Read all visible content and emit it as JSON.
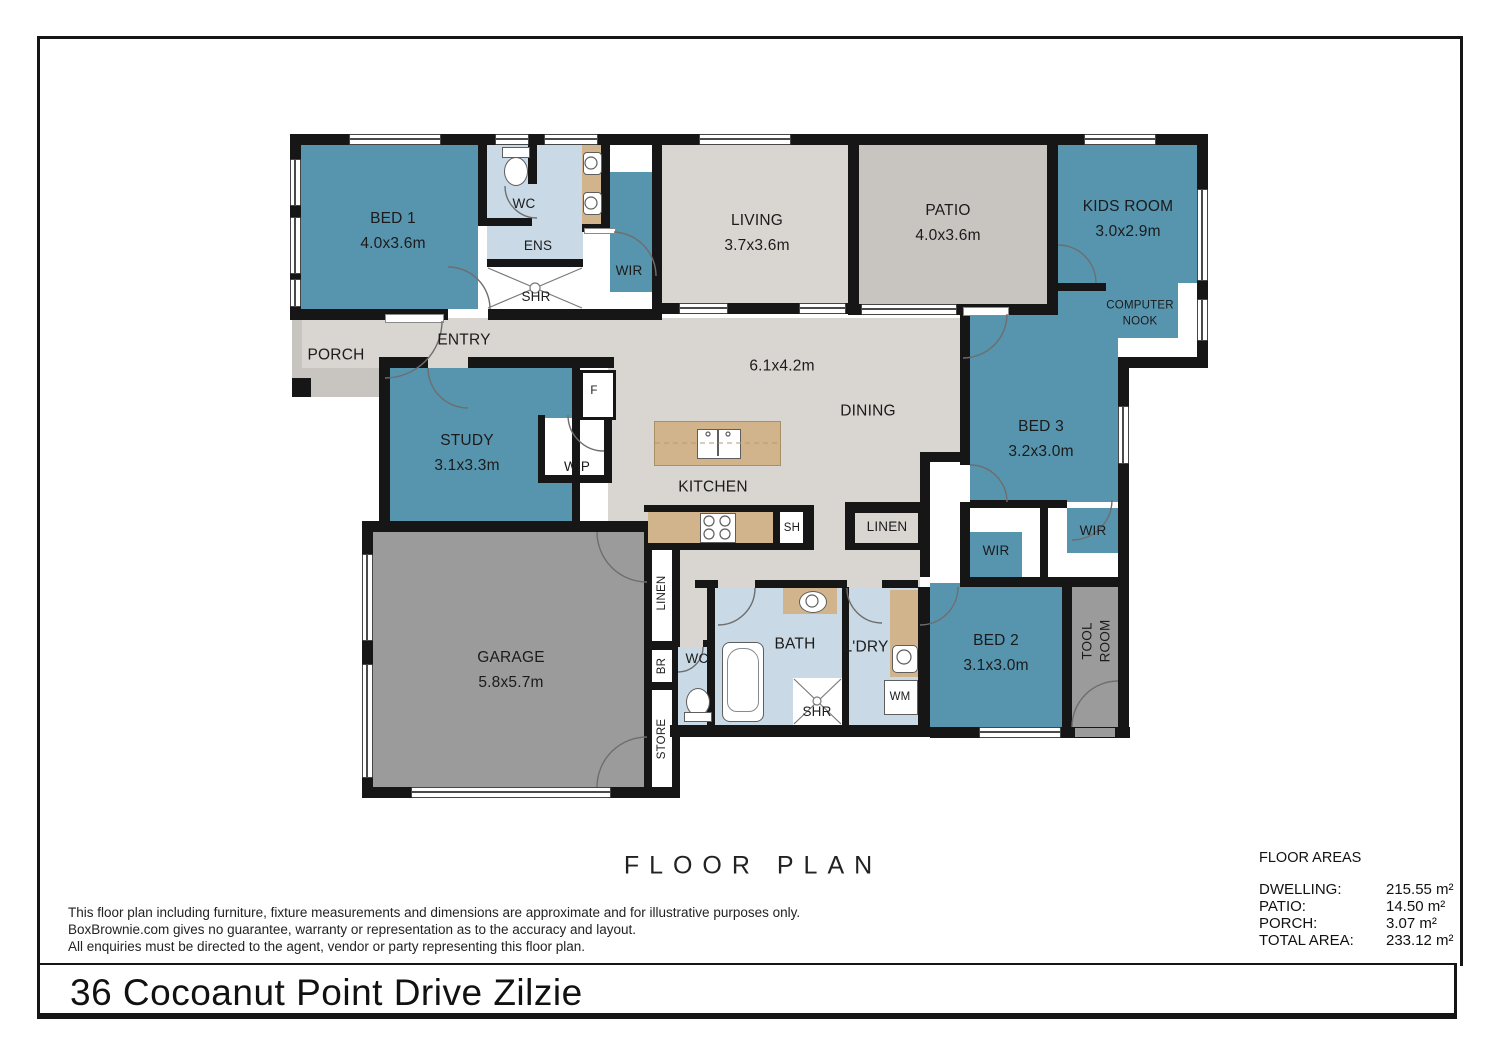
{
  "footer": {
    "title": "F L O O R   P L A N",
    "title_plain": "FLOOR PLAN",
    "address": "36 Cocoanut Point Drive Zilzie",
    "disclaimer": [
      "This floor plan including furniture, fixture measurements and dimensions are approximate and for illustrative purposes only.",
      "BoxBrownie.com gives no guarantee, warranty or representation as to the accuracy and layout.",
      "All enquiries must be directed to the agent, vendor or party representing this floor plan."
    ]
  },
  "floor_areas": {
    "heading": "FLOOR AREAS",
    "rows": [
      {
        "label": "DWELLING:",
        "value": "215.55 m²"
      },
      {
        "label": "PATIO:",
        "value": "14.50 m²"
      },
      {
        "label": "PORCH:",
        "value": "3.07 m²"
      },
      {
        "label": "TOTAL AREA:",
        "value": "233.12 m²"
      }
    ]
  },
  "rooms": {
    "bed1": "BED 1\n4.0x3.6m",
    "wc1": "WC",
    "ens": "ENS",
    "wir1": "WIR",
    "shr1": "SHR",
    "living": "LIVING\n3.7x3.6m",
    "patio": "PATIO\n4.0x3.6m",
    "kids": "KIDS ROOM\n3.0x2.9m",
    "nook": "COMPUTER\nNOOK",
    "porch": "PORCH",
    "entry": "ENTRY",
    "study": "STUDY\n3.1x3.3m",
    "wip": "WIP",
    "fridge": "F",
    "dining_dim": "6.1x4.2m",
    "dining": "DINING",
    "kitchen": "KITCHEN",
    "sh": "SH",
    "linen_center": "LINEN",
    "bed3": "BED 3\n3.2x3.0m",
    "wir3": "WIR",
    "wir2": "WIR",
    "garage": "GARAGE\n5.8x5.7m",
    "linen_vert": "LINEN",
    "br": "BR",
    "store": "STORE",
    "wc2": "WC",
    "bath": "BATH",
    "ldry": "L'DRY",
    "shr2": "SHR",
    "wm": "WM",
    "bed2": "BED 2\n3.1x3.0m",
    "tool": "TOOL\nROOM"
  },
  "colors": {
    "room_teal": "#5794ae",
    "wet_area_blue": "#c9d9e5",
    "floor_grey": "#d9d5d1",
    "patio_grey": "#c8c4c0",
    "garage_grey": "#9b9b9b",
    "bench_tan": "#d2b48c",
    "wall_black": "#161616"
  }
}
